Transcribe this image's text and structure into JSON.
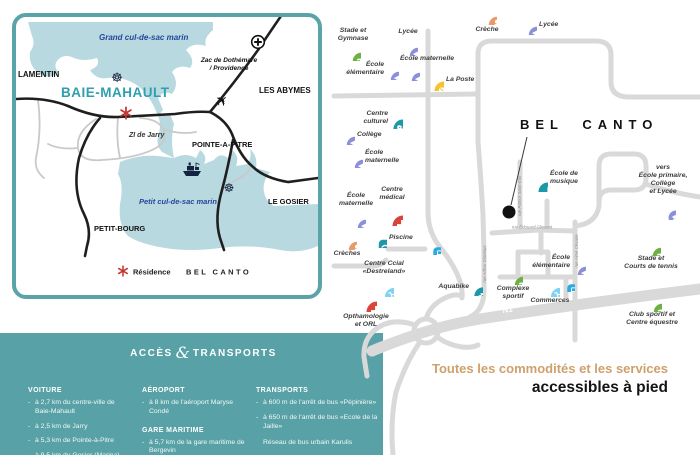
{
  "overview_map": {
    "sea_north": "Grand cul-de-sac marin",
    "sea_south": "Petit cul-de-sac marin",
    "towns": {
      "lamentin": "LAMENTIN",
      "baie_mahault": "BAIE-MAHAULT",
      "les_abymes": "LES ABYMES",
      "pointe_a_pitre": "POINTE-A-PITRE",
      "le_gosier": "LE GOSIER",
      "petit_bourg": "PETIT-BOURG"
    },
    "zac_line1": "Zac de Dothémare",
    "zac_line2": "/ Providence",
    "zi_jarry": "ZI de Jarry",
    "legend_residence": "Résidence",
    "legend_name": "BEL CANTO"
  },
  "neighborhood_map": {
    "title": "BEL CANTO",
    "n1_label": "N1",
    "streets": [
      {
        "id": "rue-patrick-saint-eloi",
        "label": "rue Patrick Saint-Eloi"
      },
      {
        "id": "rue-edouard-glissant",
        "label": "rue Édouard Glissant"
      },
      {
        "id": "rue-aime-cesaire",
        "label": "rue Aimé Césaire"
      },
      {
        "id": "rue-arthur-gionnius",
        "label": "rue Arthur Gionnius"
      }
    ],
    "tagline_line1": "Toutes les commodités et les services",
    "tagline_line2": "accessibles à pied",
    "pois": [
      {
        "id": "stade-gymnase",
        "icon": "runner",
        "color": "#6fb045",
        "x": 351,
        "y": 51,
        "size": 19,
        "label": "Stade et\nGymnase",
        "lx": 330,
        "ly": 27,
        "lw": 46,
        "la": "center"
      },
      {
        "id": "lycee-nord",
        "icon": "cap",
        "color": "#8b90d8",
        "x": 408,
        "y": 46,
        "size": 19,
        "label": "Lycée",
        "lx": 390,
        "ly": 28,
        "lw": 36,
        "la": "center"
      },
      {
        "id": "ecole-elementaire-ouest",
        "icon": "cap",
        "color": "#8b90d8",
        "x": 389,
        "y": 70,
        "size": 19,
        "label": "École\nélémentaire",
        "lx": 336,
        "ly": 61,
        "lw": 48,
        "la": "right"
      },
      {
        "id": "ecole-maternelle-nord",
        "icon": "cap",
        "color": "#8b90d8",
        "x": 410,
        "y": 71,
        "size": 19,
        "label": "École maternelle",
        "lx": 400,
        "ly": 55,
        "lw": 62,
        "la": "left"
      },
      {
        "id": "la-poste",
        "icon": "mail",
        "color": "#f5c42d",
        "x": 433,
        "y": 80,
        "size": 21,
        "label": "La Poste",
        "lx": 446,
        "ly": 76,
        "lw": 42,
        "la": "left"
      },
      {
        "id": "creche-nord",
        "icon": "baby",
        "color": "#e9996c",
        "x": 487,
        "y": 15,
        "size": 19,
        "label": "Crèche",
        "lx": 467,
        "ly": 26,
        "lw": 40,
        "la": "center"
      },
      {
        "id": "lycee-est",
        "icon": "cap",
        "color": "#8b90d8",
        "x": 527,
        "y": 25,
        "size": 19,
        "label": "Lycée",
        "lx": 539,
        "ly": 21,
        "lw": 40,
        "la": "left"
      },
      {
        "id": "centre-culturel",
        "icon": "masks",
        "color": "#1e98a9",
        "x": 392,
        "y": 118,
        "size": 21,
        "label": "Centre\nculturel",
        "lx": 346,
        "ly": 110,
        "lw": 42,
        "la": "right"
      },
      {
        "id": "college",
        "icon": "cap",
        "color": "#8b90d8",
        "x": 345,
        "y": 135,
        "size": 19,
        "label": "Collège",
        "lx": 357,
        "ly": 131,
        "lw": 40,
        "la": "left"
      },
      {
        "id": "ecole-maternelle-ouest",
        "icon": "cap",
        "color": "#8b90d8",
        "x": 353,
        "y": 158,
        "size": 19,
        "label": "École\nmaternelle",
        "lx": 365,
        "ly": 149,
        "lw": 46,
        "la": "left"
      },
      {
        "id": "ecole-maternelle-sud",
        "icon": "cap",
        "color": "#8b90d8",
        "x": 356,
        "y": 218,
        "size": 19,
        "label": "École\nmaternelle",
        "lx": 334,
        "ly": 192,
        "lw": 44,
        "la": "center"
      },
      {
        "id": "centre-medical",
        "icon": "cross",
        "color": "#d9453c",
        "x": 392,
        "y": 215,
        "size": 22,
        "label": "Centre\nmédical",
        "lx": 371,
        "ly": 186,
        "lw": 42,
        "la": "center"
      },
      {
        "id": "piscine",
        "icon": "swim",
        "color": "#1e98a9",
        "x": 377,
        "y": 238,
        "size": 19,
        "label": "Piscine",
        "lx": 389,
        "ly": 234,
        "lw": 36,
        "la": "left"
      },
      {
        "id": "creches-sud",
        "icon": "baby",
        "color": "#e9996c",
        "x": 347,
        "y": 240,
        "size": 19,
        "label": "Crèches",
        "lx": 327,
        "ly": 250,
        "lw": 40,
        "la": "center"
      },
      {
        "id": "arret-bus-ouest",
        "icon": "bus",
        "color": "#2aabe3",
        "x": 432,
        "y": 246,
        "size": 17
      },
      {
        "id": "centre-commercial-destreland",
        "icon": "cart",
        "color": "#7fd2f2",
        "x": 384,
        "y": 287,
        "size": 20,
        "label": "Centre Ccial\n«Destreland»",
        "lx": 352,
        "ly": 260,
        "lw": 64,
        "la": "center"
      },
      {
        "id": "ophtalmologie-orl",
        "icon": "cross",
        "color": "#d9453c",
        "x": 366,
        "y": 301,
        "size": 22,
        "label": "Opthamologie\net ORL",
        "lx": 334,
        "ly": 313,
        "lw": 64,
        "la": "center"
      },
      {
        "id": "aquabike",
        "icon": "bike",
        "color": "#1e98a9",
        "x": 473,
        "y": 286,
        "size": 19,
        "label": "Aquabike",
        "lx": 425,
        "ly": 283,
        "lw": 44,
        "la": "right"
      },
      {
        "id": "ecole-musique",
        "icon": "music",
        "color": "#1e98a9",
        "x": 537,
        "y": 181,
        "size": 21,
        "label": "École de\nmusique",
        "lx": 550,
        "ly": 170,
        "lw": 50,
        "la": "left"
      },
      {
        "id": "ecole-elementaire-est",
        "icon": "cap",
        "color": "#8b90d8",
        "x": 576,
        "y": 265,
        "size": 19,
        "label": "École\nélémentaire",
        "lx": 522,
        "ly": 254,
        "lw": 48,
        "la": "right"
      },
      {
        "id": "arret-bus-est",
        "icon": "bus",
        "color": "#2aabe3",
        "x": 566,
        "y": 283,
        "size": 17
      },
      {
        "id": "commerces",
        "icon": "cart",
        "color": "#7fd2f2",
        "x": 550,
        "y": 287,
        "size": 20,
        "label": "Commerces",
        "lx": 520,
        "ly": 297,
        "lw": 60,
        "la": "center"
      },
      {
        "id": "complexe-sportif",
        "icon": "runner",
        "color": "#6fb045",
        "x": 513,
        "y": 275,
        "size": 19,
        "label": "Complexe\nsportif",
        "lx": 487,
        "ly": 285,
        "lw": 52,
        "la": "center"
      },
      {
        "id": "stade-courts-tennis",
        "icon": "runner",
        "color": "#6fb045",
        "x": 651,
        "y": 246,
        "size": 19,
        "label": "Stade et\nCourts de tennis",
        "lx": 614,
        "ly": 255,
        "lw": 74,
        "la": "center"
      },
      {
        "id": "club-sportif-equestre",
        "icon": "runner",
        "color": "#6fb045",
        "x": 652,
        "y": 302,
        "size": 19,
        "label": "Club sportif et\nCentre équestre",
        "lx": 613,
        "ly": 311,
        "lw": 78,
        "la": "center"
      },
      {
        "id": "vers-ecoles",
        "icon": "pin",
        "color": "#8b90d8",
        "x": 665,
        "y": 208,
        "size": 21,
        "label": "vers\nÉcole primaire,\nCollège\net Lycée",
        "lx": 628,
        "ly": 164,
        "lw": 70,
        "la": "center"
      }
    ]
  },
  "access_panel": {
    "title_1": "ACCÈS",
    "amp": "&",
    "title_2": "TRANSPORTS",
    "columns": [
      {
        "sections": [
          {
            "title": "VOITURE",
            "items": [
              "à 2,7 km du centre-ville de Baie-Mahault",
              "à 2,5 km de Jarry",
              "à 5,3 km de Pointe-à-Pitre",
              "à 9,5 km du Gosier (Marina)"
            ]
          }
        ]
      },
      {
        "sections": [
          {
            "title": "AÉROPORT",
            "items": [
              "à 8 km de l'aéroport Maryse Condé"
            ]
          },
          {
            "title": "GARE MARITIME",
            "items": [
              "à 5,7 km de la gare maritime de Bergevin"
            ]
          }
        ]
      },
      {
        "sections": [
          {
            "title": "TRANSPORTS",
            "items": [
              "à 600 m de l'arrêt de bus «Pépinière»",
              "à 650 m de l'arrêt de bus «Ecole de la Jaille»"
            ],
            "footer": "Réseau de bus urbain Karulis"
          }
        ]
      }
    ]
  },
  "colors": {
    "teal_panel": "#58a2a7",
    "sea": "#b9d9e0",
    "navy_text": "#24469b",
    "city_teal": "#2d9fae",
    "marker_red": "#c4332e",
    "road_grey": "#d9d9d9",
    "tagline_tan": "#cfa06c"
  }
}
